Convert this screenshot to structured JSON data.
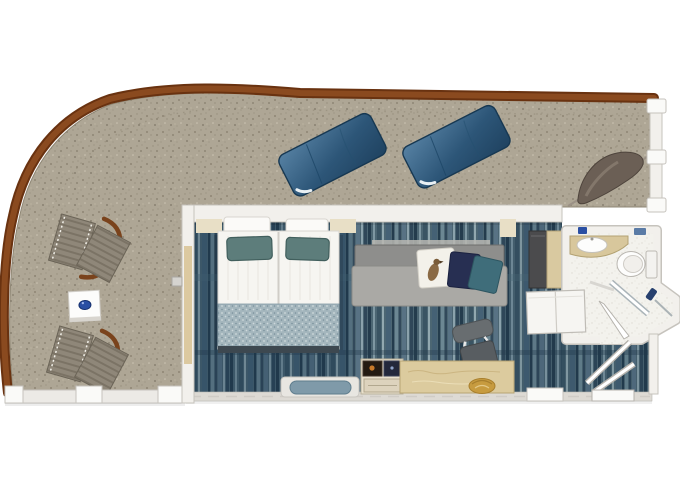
{
  "page": {
    "title": "Stateroom floor plan",
    "description": "Top-down floor plan of a cruise ship suite with bedroom, bathroom and a large wrap-around balcony"
  },
  "labels": {
    "plan": "Suite floor plan with wrap-around balcony",
    "balcony": "Wrap-around balcony deck",
    "railing": "Curved wooden balcony railing",
    "bedroom": "Bedroom and sitting area",
    "bathroom": "Bathroom",
    "entry": "Entry hall with door swing",
    "bed": "Double bed with two teal pillows and foot runner",
    "sofa": "Grey sofa with three accent pillows",
    "desk": "Writing desk",
    "desk_chair": "Desk chair",
    "minibar": "Minibar cabinet with screens",
    "bench": "Window bench with blue cushion",
    "wardrobe": "Wardrobe with double doors",
    "closet": "Tall storage cabinets",
    "toilet": "Toilet",
    "sink": "Vanity counter with sink",
    "shower": "Glass shower corner",
    "sun_loungers": "Two padded sun loungers",
    "deck_chairs": "Two folding wooden deck chairs",
    "side_table": "Square balcony side table with blue bowl",
    "hammock_chair": "Curved sling lounge chair",
    "balcony_door": "Sliding balcony glass door"
  },
  "colors": {
    "background": "#ffffff",
    "deck": "#aea695",
    "deck_speck_dark": "#847b6a",
    "deck_speck_light": "#cdc5b3",
    "railing": "#8a4a1f",
    "railing_dark": "#693210",
    "wall": "#f2f0ec",
    "wall_edge": "#c6c3bd",
    "carpet": "#4c6673",
    "carpet_streak_dark": "#243c4d",
    "carpet_streak_light": "#8ba2ac",
    "lounger": "#2d5678",
    "lounger_light": "#5681a3",
    "deck_chair_fabric": "#8f8779",
    "deck_chair_wood": "#7a431c",
    "mattress": "#f6f5f1",
    "runner": "#a4b6bd",
    "pillow_teal": "#5d7d7b",
    "sofa_seat": "#aaa9a5",
    "sofa_back": "#8e8e8c",
    "cushion_white": "#f3f1ea",
    "cushion_navy": "#272f52",
    "cushion_teal": "#3f6d7a",
    "desk_wood": "#dccb9e",
    "counter": "#d8c79c",
    "bath_floor": "#f3f2ed",
    "fixture": "#fdfdfc",
    "cabinet_dark": "#4b4b4d",
    "cabinet_tan": "#d9c9a0",
    "table_white": "#fcfcfb",
    "bowl_blue": "#2a4fa3",
    "gold": "#c79b3f",
    "glass_door": "#dcc9a0"
  }
}
